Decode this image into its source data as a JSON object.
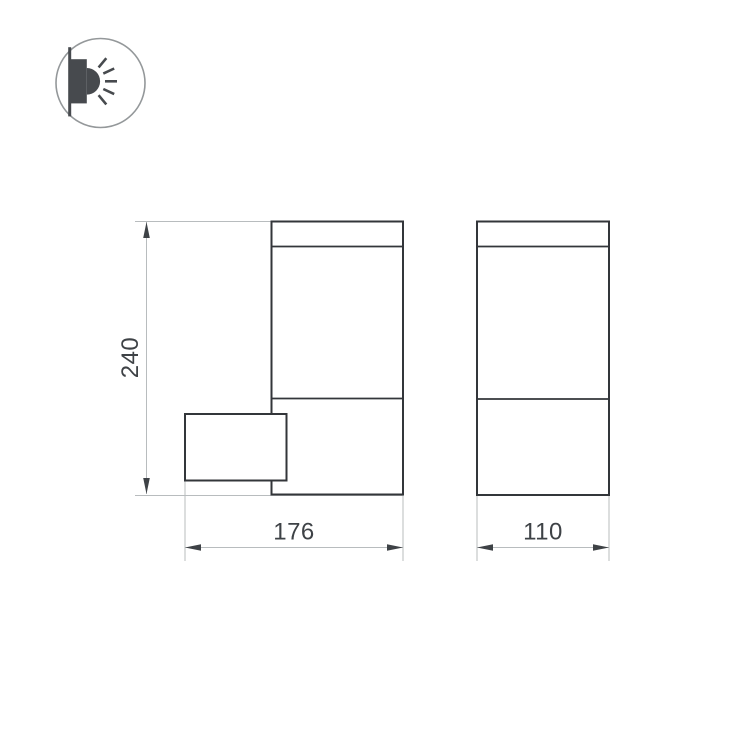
{
  "page": {
    "background_color": "#ffffff"
  },
  "icon": {
    "name": "wall-mounted-light-pictogram",
    "circle_stroke_color": "#94989a",
    "glyph_color": "#474a4e",
    "ray_count": 5
  },
  "drawing": {
    "outline_color": "#33363a",
    "dimension_line_color": "#b8bcbe",
    "dimension_text_color": "#3e4246",
    "dimensions": {
      "height": {
        "label": "240",
        "orientation": "vertical"
      },
      "depth": {
        "label": "176",
        "orientation": "horizontal"
      },
      "width": {
        "label": "110",
        "orientation": "horizontal"
      }
    }
  }
}
